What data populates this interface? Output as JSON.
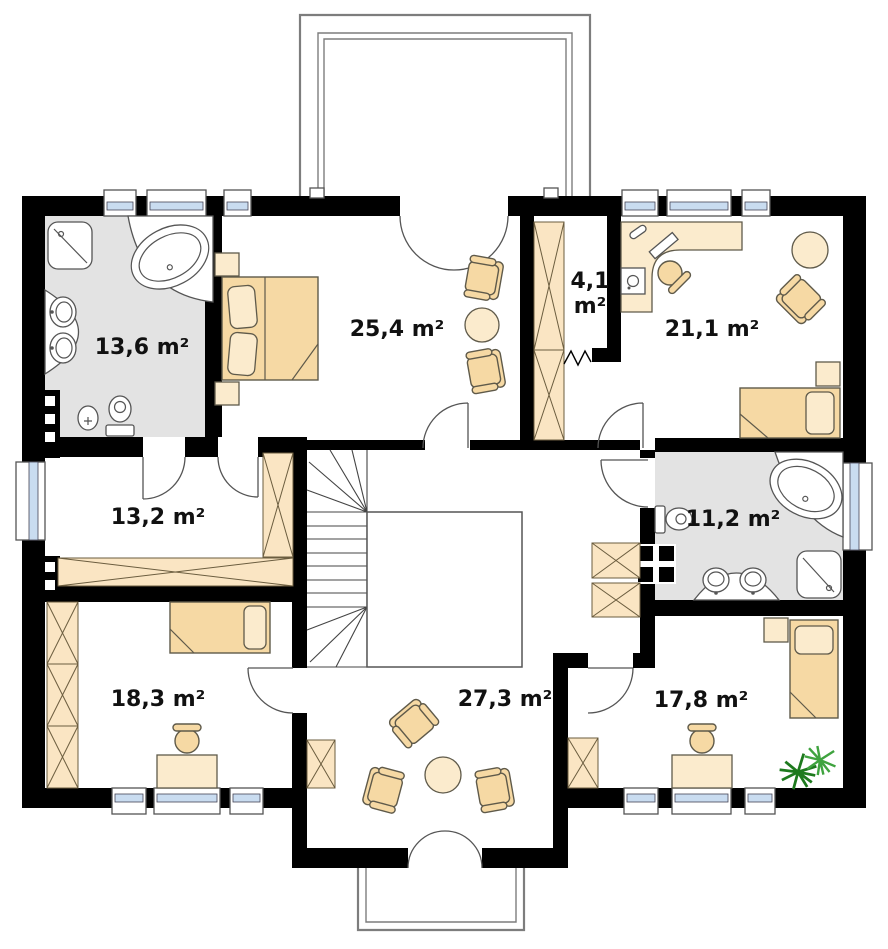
{
  "plan": {
    "rooms": [
      {
        "name": "bathroom-upper",
        "area": "13,6 m²"
      },
      {
        "name": "master-bedroom",
        "area": "25,4 m²"
      },
      {
        "name": "wardrobe-closet",
        "area": "4,1 m²",
        "area_lines": [
          "4,1",
          "m²"
        ]
      },
      {
        "name": "bedroom-upper-right",
        "area": "21,1 m²"
      },
      {
        "name": "dressing-room",
        "area": "13,2 m²"
      },
      {
        "name": "bathroom-lower",
        "area": "11,2 m²"
      },
      {
        "name": "bedroom-lower-left",
        "area": "18,3 m²"
      },
      {
        "name": "hall",
        "area": "27,3 m²"
      },
      {
        "name": "bedroom-lower-right",
        "area": "17,8 m²"
      }
    ],
    "colors": {
      "wall": "#000000",
      "furniture": "#F6D9A4",
      "furniture_light": "#FBEBCD",
      "wardrobe": "#FAE5C3",
      "bathroom_floor": "#E3E3E3",
      "window_glass": "#C9DCF0",
      "plant_dark": "#1E7A1E",
      "plant_light": "#3FA33F",
      "label_color": "#111111"
    }
  }
}
